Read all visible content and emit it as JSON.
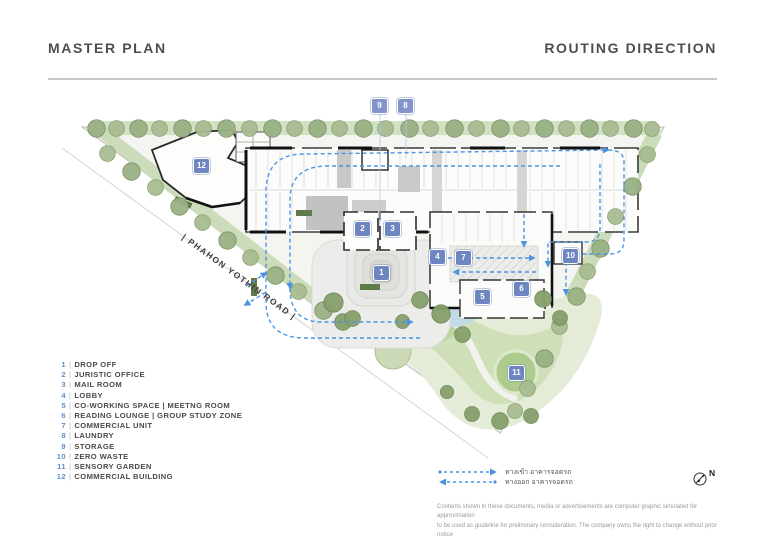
{
  "header": {
    "title_left": "MASTER PLAN",
    "title_right": "ROUTING DIRECTION"
  },
  "plan": {
    "road_label": "| PHAHON YOTHIN ROAD |",
    "markers": [
      {
        "num": "9",
        "x": 379,
        "y": 105,
        "variant": "light"
      },
      {
        "num": "8",
        "x": 405,
        "y": 105,
        "variant": "light"
      },
      {
        "num": "12",
        "x": 201,
        "y": 165,
        "variant": "dark"
      },
      {
        "num": "2",
        "x": 362,
        "y": 228,
        "variant": "dark"
      },
      {
        "num": "3",
        "x": 392,
        "y": 228,
        "variant": "dark"
      },
      {
        "num": "1",
        "x": 381,
        "y": 272,
        "variant": "dark"
      },
      {
        "num": "4",
        "x": 437,
        "y": 256,
        "variant": "dark"
      },
      {
        "num": "7",
        "x": 463,
        "y": 257,
        "variant": "dark"
      },
      {
        "num": "10",
        "x": 570,
        "y": 255,
        "variant": "dark"
      },
      {
        "num": "5",
        "x": 482,
        "y": 296,
        "variant": "dark"
      },
      {
        "num": "6",
        "x": 521,
        "y": 288,
        "variant": "dark"
      },
      {
        "num": "11",
        "x": 516,
        "y": 372,
        "variant": "dark"
      }
    ]
  },
  "legend": {
    "items": [
      {
        "num": "1",
        "label": "DROP OFF"
      },
      {
        "num": "2",
        "label": "JURISTIC OFFICE"
      },
      {
        "num": "3",
        "label": "MAIL ROOM"
      },
      {
        "num": "4",
        "label": "LOBBY"
      },
      {
        "num": "5",
        "label": "CO-WORKING SPACE | MEETNG ROOM"
      },
      {
        "num": "6",
        "label": "READING LOUNGE | GROUP STUDY ZONE"
      },
      {
        "num": "7",
        "label": "COMMERCIAL UNIT"
      },
      {
        "num": "8",
        "label": "LAUNDRY"
      },
      {
        "num": "9",
        "label": "STORAGE"
      },
      {
        "num": "10",
        "label": "ZERO WASTE"
      },
      {
        "num": "11",
        "label": "SENSORY GARDEN"
      },
      {
        "num": "12",
        "label": "COMMERCIAL BUILDING"
      }
    ]
  },
  "routing_legend": {
    "in_label": "ทางเข้า อาคารจอดรถ",
    "out_label": "ทางออก อาคารจอดรถ",
    "north_label": "N"
  },
  "disclaimer": {
    "line1": "Contents  shown in these documents, media or advertisements are computer graphic simulated for approximation",
    "line2": "to be used as guideline for preliminary consideration. The company owns the right to change without prior notice"
  },
  "colors": {
    "accent_blue": "#4b94e4",
    "marker_blue": "#6d85c1",
    "marker_blue_light": "#8494cb",
    "legend_number_blue": "#5b8fc9",
    "tree_green": "#9ab184",
    "lawn_green": "#d2e1c2"
  }
}
